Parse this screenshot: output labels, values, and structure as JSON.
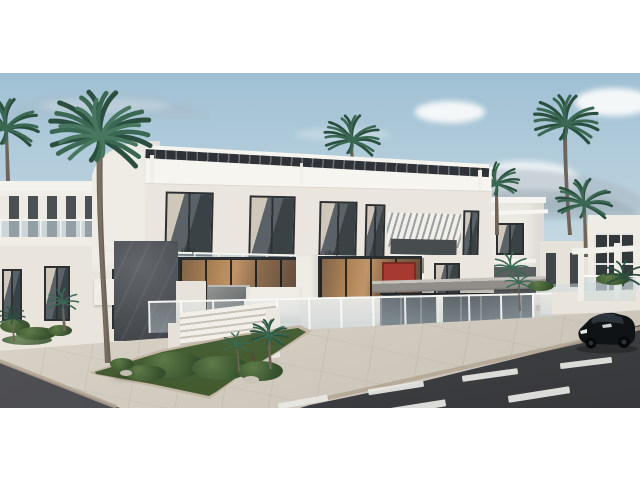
{
  "scene": {
    "description": "3D architectural rendering: modern white two-storey residential complex with rooftop pergola, glass balconies, ground-floor restaurant, palm trees, landscaped corner plot, grey street with dashed white lane markings and a parked black car",
    "signs": [
      "shop",
      "shop"
    ],
    "palette": {
      "sky-top": "#9fc0d4",
      "sky-mid": "#c0d5e0",
      "sky-bottom": "#d7e1e7",
      "cloud": "#f4f7f8",
      "mountain": "#a8b5be",
      "wall-white": "#efece6",
      "wall-bright": "#f7f5f0",
      "wall-warm": "#e9e4dc",
      "wall-shadow": "#ddd7cd",
      "frame-dark": "#2e3234",
      "glass-cool": "#b9c8cf",
      "interior-warm": "#b08658",
      "interior-deep": "#7e6248",
      "art-red": "#a63a30",
      "stone-dark": "#53565a",
      "stone-warm": "#95897b",
      "pergola-dark": "#2f3337",
      "sidewalk": "#d6d0c5",
      "sidewalk-dark": "#c8c1b5",
      "curb": "#b3a493",
      "road": "#46484b",
      "road-dark": "#37383b",
      "road-mark": "#e9e9e5",
      "grass": "#50693c",
      "bush-dark": "#35502c",
      "bush-light": "#5d7a47",
      "frond": "#3a6852",
      "frond-dark": "#2b4f3f",
      "trunk": "#6e6459",
      "car-body": "#101316",
      "car-glass": "#2c343b",
      "white": "#ffffff"
    }
  }
}
